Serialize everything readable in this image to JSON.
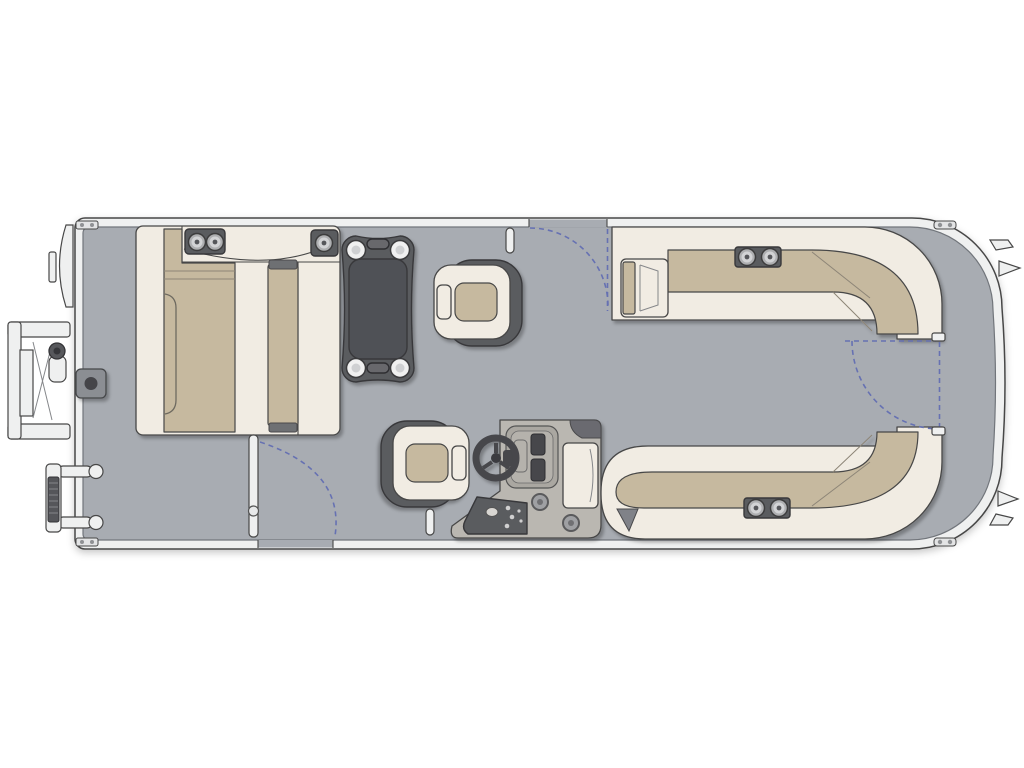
{
  "page": {
    "type": "pontoon-boat-floorplan-diagram",
    "view": "top-down",
    "orientation": "bow-left, stern-right",
    "visible_text": []
  },
  "colors": {
    "outline": "#474747",
    "deckline": "#71757b",
    "hull": "#eff0f0",
    "deck": "#a8acb2",
    "seat": "#f1ece3",
    "cushion": "#c6b99f",
    "dark": "#5a5b5f",
    "darkline": "#38383a",
    "tabletop": "#505156",
    "gate": "#6671b2"
  },
  "components": {
    "hull": {
      "shape": "rounded rectangle, large radius stern corners",
      "hardware": [
        "bow hinge plates (2)",
        "stern mooring cleats (2)",
        "stern motor-mount fins (2)",
        "stern bracket tabs (2)"
      ]
    },
    "exterior": {
      "bow_gate_panel": "curved panel protruding at bow (left)",
      "bow_side_ladder": "folded boarding ladder, upper left exterior",
      "port_boarding_ladder": "folded two-rail ladder, lower left exterior"
    },
    "bow_lounge": {
      "layout": "two facing chaise lounges with head console",
      "console_cupholders": 3,
      "cushions": 2,
      "deck_fitting": "square table-base/fuel fitting on deck aft of lounge"
    },
    "dinette_table": {
      "shape": "dark pedestal table with lobed corners",
      "corner_cupholders": 4,
      "handles": 2
    },
    "captain_chairs": {
      "count": 2,
      "forward_chair_facing": "left toward table",
      "helm_chair_facing": "right toward helm"
    },
    "helm_console": {
      "steering_wheel": true,
      "instrument_panel": true,
      "speaker_circles": 2,
      "kick_panel_controls": true,
      "side_cap_panel": true
    },
    "stern_benches": {
      "top": {
        "shape": "L-bench wrapping stern corner",
        "armrest": true,
        "cupholders": 2
      },
      "bottom": {
        "shape": "L-bench wrapping stern corner",
        "rounded_end": true,
        "cupholders": 2
      }
    },
    "gates": {
      "starboard_top_gate": "open, dashed swing arc",
      "port_bottom_gate": "open white gate bar with swing arc",
      "stern_gate": "dashed open/closed positions with swing arc",
      "latch_posts": 2
    }
  }
}
